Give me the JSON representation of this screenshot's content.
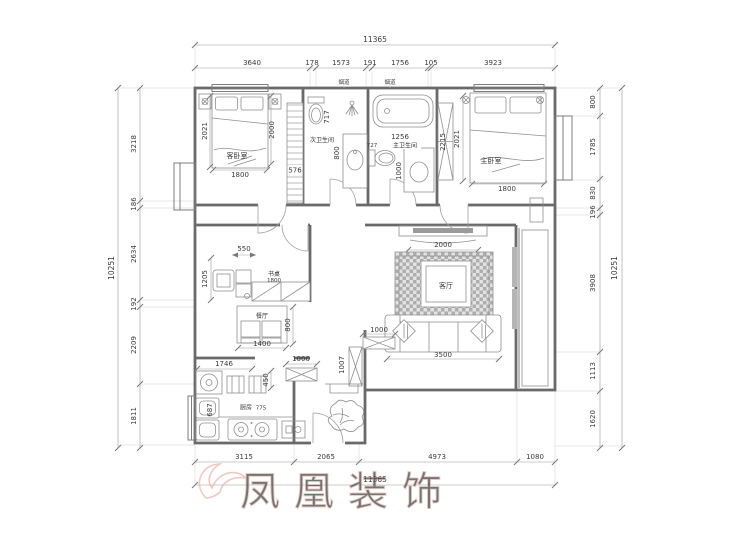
{
  "watermark": {
    "text": "凤凰装饰"
  },
  "labels": {
    "guest_bedroom": "客卧室",
    "second_bathroom": "次卫生间",
    "master_bathroom": "主卫生间",
    "master_bedroom": "主卧室",
    "desk": "书桌",
    "dining": "餐厅",
    "living": "客厅",
    "kitchen": "厨房",
    "flue_left": "烟道",
    "flue_right": "烟道"
  },
  "dims": {
    "top": {
      "total": "11365",
      "segments": [
        "3640",
        "178",
        "1573",
        "191",
        "1756",
        "105",
        "3923"
      ]
    },
    "bottom": {
      "total": "11365",
      "segments": [
        "3115",
        "2065",
        "4973",
        "1080"
      ]
    },
    "left": {
      "total": "10251",
      "segments": [
        "3218",
        "186",
        "2634",
        "192",
        "2209",
        "1811"
      ]
    },
    "right": {
      "total": "10251",
      "segments": [
        "800",
        "1785",
        "830",
        "196",
        "3908",
        "1113",
        "1620"
      ]
    },
    "interior": {
      "guest_bed_left": "2021",
      "guest_bed_right": "2000",
      "guest_bed_width": "1800",
      "guest_wardrobe": "576",
      "bath2_toilet": "717",
      "bath2_basin": "800",
      "bath1_width": "1256",
      "bath1_toilet": "727",
      "bath1_basin": "1000",
      "master_wardrobe": "2215",
      "master_bed_len": "2021",
      "master_bed_width": "1800",
      "desk_col": "550",
      "desk_depth": "1205",
      "desk_len": "1800",
      "dining_w": "1400",
      "dining_d": "800",
      "tv_wall": "2000",
      "sofa": "3500",
      "kitchen_top": "1746",
      "kitchen_stool": "450",
      "kitchen_sink": "687",
      "kitchen_counter": "775",
      "shoe_cabinet": "1000",
      "hall_cabinet": "1007",
      "side_cabinet": "1000"
    }
  },
  "colors": {
    "wall": "#6a6a6a",
    "dimension": "#9a9a9a",
    "text": "#3a3a3a",
    "watermark": "#e0b2a6"
  }
}
